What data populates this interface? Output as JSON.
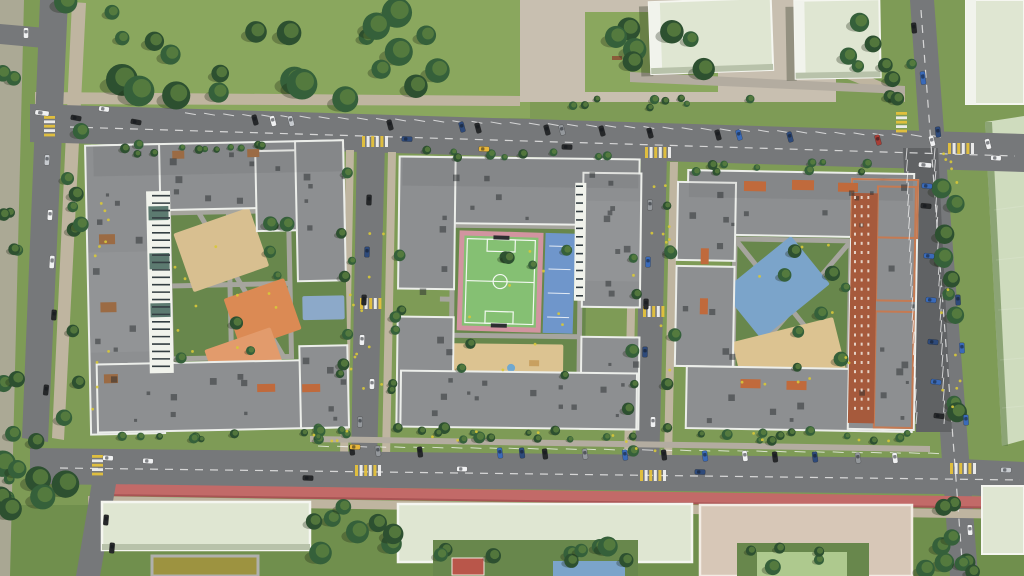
{
  "meta": {
    "scene": "aerial-residential-complex"
  },
  "palette": {
    "grass": "#7e9b56",
    "grass_dark": "#6d8c4b",
    "park": "#8aa75e",
    "lawn": "#68874c",
    "field": "#cfdcbe",
    "plaza": "#c8bfb0",
    "path": "#bfb5a0",
    "sidewalk": "#b3aca0",
    "road": "#76787a",
    "road_dark": "#606264",
    "lane_red": "#c26a68",
    "lane_red2": "#a85454",
    "line": "#eeeeee",
    "yellow": "#e5c23c",
    "roof": "#8d8f91",
    "roof_dark": "#7b7d7f",
    "parapet": "#eceeea",
    "mint": "#dfe6d2",
    "mint_face": "#f1f3ec",
    "mint_shade": "#b8c2aa",
    "brick": "#a65a3c",
    "brick_par": "#c57a52",
    "pergola": "#c06a3c",
    "pergola2": "#9b6b44",
    "tan": "#d8bf90",
    "orange1": "#db8a54",
    "orange2": "#e29b6c",
    "blue_play": "#7ba4ca",
    "blue_tarp": "#8ca9c9",
    "court_green": "#85c073",
    "court_pink": "#d294a0",
    "court_blue": "#6f96cb",
    "sand": "#dcc391",
    "olive": "#9d9340",
    "pink_bld": "#d7c7b7",
    "teal": "#5c7a70",
    "court_path": "#a6a59e",
    "unit": "rgba(40,44,46,0.5)",
    "shadow": "rgba(25,35,18,0.30)",
    "tree_dark": "#2d5030",
    "tree_mid": "#35603a",
    "tree_light": "#5f8340",
    "flower": "#d8c838",
    "red_roof": "#b9564a",
    "car": {
      "wh": "#f0f1f2",
      "bk": "#26282a",
      "gy": "#94989c",
      "nv": "#2e4a7a",
      "bl": "#3a6ab8",
      "yl": "#e8b63a",
      "rd": "#a83e36",
      "sv": "#c6cace"
    }
  },
  "scene": {
    "tree_clusters": [
      [
        60,
        0,
        440,
        100,
        24,
        7,
        16,
        1
      ],
      [
        585,
        12,
        132,
        78,
        7,
        6,
        12,
        3
      ],
      [
        838,
        18,
        58,
        82,
        5,
        6,
        11,
        4
      ],
      [
        0,
        0,
        18,
        560,
        12,
        5,
        9,
        5
      ],
      [
        62,
        70,
        24,
        360,
        9,
        5,
        9,
        6
      ],
      [
        95,
        144,
        248,
        10,
        12,
        3,
        5,
        7
      ],
      [
        400,
        150,
        232,
        10,
        10,
        3,
        5,
        8
      ],
      [
        678,
        160,
        235,
        12,
        10,
        3,
        5,
        9
      ],
      [
        340,
        152,
        12,
        305,
        7,
        4,
        7,
        10
      ],
      [
        390,
        152,
        12,
        305,
        7,
        4,
        7,
        11
      ],
      [
        626,
        162,
        12,
        300,
        6,
        4,
        7,
        12
      ],
      [
        666,
        162,
        12,
        300,
        6,
        4,
        7,
        13
      ],
      [
        940,
        138,
        20,
        430,
        13,
        6,
        10,
        14
      ],
      [
        310,
        428,
        618,
        12,
        14,
        4,
        6,
        15
      ],
      [
        170,
        212,
        122,
        160,
        8,
        4,
        8,
        16
      ],
      [
        458,
        228,
        120,
        160,
        7,
        4,
        8,
        17
      ],
      [
        737,
        242,
        112,
        155,
        8,
        4,
        8,
        18
      ],
      [
        314,
        506,
        80,
        64,
        8,
        7,
        12,
        19
      ],
      [
        0,
        440,
        88,
        134,
        8,
        8,
        14,
        20
      ],
      [
        436,
        542,
        196,
        30,
        9,
        6,
        10,
        21
      ],
      [
        740,
        548,
        124,
        26,
        5,
        5,
        8,
        22
      ],
      [
        918,
        498,
        58,
        76,
        6,
        6,
        10,
        23
      ],
      [
        520,
        98,
        315,
        10,
        9,
        3,
        5,
        24
      ],
      [
        884,
        60,
        28,
        60,
        4,
        5,
        8,
        25
      ],
      [
        100,
        432,
        240,
        10,
        9,
        3,
        5,
        26
      ],
      [
        408,
        430,
        225,
        10,
        8,
        3,
        5,
        27
      ],
      [
        690,
        432,
        222,
        10,
        8,
        3,
        5,
        28
      ]
    ],
    "flowers": [
      [
        170,
        215,
        120,
        150,
        10
      ],
      [
        458,
        230,
        120,
        140,
        8
      ],
      [
        736,
        242,
        115,
        150,
        10
      ],
      [
        346,
        155,
        40,
        300,
        12
      ],
      [
        630,
        165,
        40,
        300,
        12
      ],
      [
        90,
        150,
        20,
        280,
        10
      ],
      [
        940,
        150,
        25,
        280,
        12
      ],
      [
        310,
        430,
        620,
        12,
        14
      ]
    ],
    "roof_units": [
      [
        100,
        150,
        240,
        55,
        10,
        31
      ],
      [
        92,
        200,
        50,
        220,
        8,
        32
      ],
      [
        100,
        368,
        240,
        55,
        10,
        33
      ],
      [
        302,
        148,
        40,
        130,
        5,
        34
      ],
      [
        302,
        352,
        40,
        70,
        4,
        35
      ],
      [
        405,
        162,
        230,
        55,
        9,
        36
      ],
      [
        400,
        165,
        50,
        250,
        7,
        37
      ],
      [
        585,
        178,
        50,
        145,
        6,
        38
      ],
      [
        585,
        338,
        50,
        85,
        5,
        39
      ],
      [
        408,
        376,
        225,
        48,
        8,
        40
      ],
      [
        690,
        176,
        215,
        52,
        9,
        41
      ],
      [
        680,
        190,
        52,
        165,
        7,
        42
      ],
      [
        878,
        188,
        36,
        230,
        6,
        43
      ],
      [
        692,
        374,
        215,
        52,
        8,
        44
      ]
    ],
    "stall_rows": [
      [
        185,
        112.7,
        930,
        135.2,
        40,
        11,
        100
      ],
      [
        318,
        446,
        928,
        453,
        33,
        11,
        93
      ],
      [
        906,
        160,
        916,
        424,
        24,
        12,
        5
      ],
      [
        934,
        160,
        944,
        424,
        24,
        12,
        5
      ]
    ],
    "dashes": [
      [
        70,
        127,
        1015,
        156
      ],
      [
        60,
        468,
        1020,
        480
      ],
      [
        921,
        10,
        962,
        560
      ]
    ],
    "crosswalks": [
      [
        44,
        116,
        5,
        0
      ],
      [
        362,
        136,
        6,
        1
      ],
      [
        645,
        147,
        6,
        1
      ],
      [
        948,
        143,
        6,
        1
      ],
      [
        896,
        112,
        5,
        0
      ],
      [
        360,
        298,
        5,
        1
      ],
      [
        643,
        306,
        5,
        1
      ],
      [
        355,
        465,
        6,
        1
      ],
      [
        640,
        470,
        6,
        1
      ],
      [
        950,
        463,
        6,
        1
      ],
      [
        92,
        455,
        5,
        0
      ]
    ],
    "window_lines": [
      [
        150,
        192,
        22,
        178,
        24
      ],
      [
        574,
        182,
        11,
        118,
        14
      ]
    ],
    "brick_dots": [
      852,
      194,
      24,
      226,
      3,
      24
    ],
    "cars": [
      [
        255,
        120,
        75,
        "bk"
      ],
      [
        273,
        121,
        75,
        "wh"
      ],
      [
        291,
        121,
        75,
        "sv"
      ],
      [
        390,
        125,
        75,
        "bk"
      ],
      [
        462,
        127,
        75,
        "nv"
      ],
      [
        478,
        128,
        75,
        "bk"
      ],
      [
        547,
        130,
        75,
        "bk"
      ],
      [
        562,
        130,
        75,
        "gy"
      ],
      [
        602,
        131,
        75,
        "bk"
      ],
      [
        650,
        133,
        75,
        "bk"
      ],
      [
        718,
        135,
        75,
        "bk"
      ],
      [
        739,
        135,
        75,
        "bl"
      ],
      [
        790,
        137,
        75,
        "nv"
      ],
      [
        878,
        140,
        75,
        "rd"
      ],
      [
        932,
        141,
        75,
        "wh"
      ],
      [
        988,
        144,
        75,
        "wh"
      ],
      [
        42,
        113,
        7,
        "wh",
        14
      ],
      [
        76,
        118,
        10,
        "bk"
      ],
      [
        104,
        109,
        8,
        "wh"
      ],
      [
        136,
        122,
        10,
        "bk"
      ],
      [
        407,
        139,
        2,
        "nv"
      ],
      [
        484,
        149,
        2,
        "yl"
      ],
      [
        567,
        147,
        2,
        "bk"
      ],
      [
        26,
        33,
        90,
        "wh"
      ],
      [
        47,
        160,
        93,
        "sv"
      ],
      [
        50,
        215,
        93,
        "wh"
      ],
      [
        52,
        262,
        94,
        "wh",
        13
      ],
      [
        54,
        315,
        94,
        "bk"
      ],
      [
        46,
        390,
        96,
        "bk"
      ],
      [
        369,
        200,
        92,
        "bk"
      ],
      [
        367,
        252,
        92,
        "nv"
      ],
      [
        364,
        300,
        92,
        "bk"
      ],
      [
        362,
        340,
        92,
        "wh"
      ],
      [
        372,
        384,
        91,
        "wh"
      ],
      [
        360,
        422,
        92,
        "gy"
      ],
      [
        650,
        205,
        91,
        "gy"
      ],
      [
        648,
        262,
        91,
        "bl"
      ],
      [
        646,
        304,
        91,
        "bk"
      ],
      [
        645,
        352,
        91,
        "nv"
      ],
      [
        653,
        422,
        90,
        "wh"
      ],
      [
        914,
        28,
        84,
        "bk"
      ],
      [
        923,
        78,
        84,
        "bl",
        13
      ],
      [
        938,
        132,
        84,
        "nv"
      ],
      [
        958,
        300,
        87,
        "nv"
      ],
      [
        962,
        348,
        87,
        "bl"
      ],
      [
        966,
        420,
        87,
        "bl"
      ],
      [
        970,
        530,
        87,
        "wh"
      ],
      [
        996,
        158,
        3,
        "wh"
      ],
      [
        352,
        450,
        83,
        "bk"
      ],
      [
        378,
        451,
        83,
        "gy"
      ],
      [
        420,
        452,
        83,
        "bk"
      ],
      [
        500,
        453,
        83,
        "bl"
      ],
      [
        522,
        453,
        83,
        "nv"
      ],
      [
        545,
        454,
        83,
        "bk"
      ],
      [
        585,
        454,
        83,
        "gy"
      ],
      [
        625,
        455,
        83,
        "bl"
      ],
      [
        664,
        455,
        83,
        "bk"
      ],
      [
        705,
        456,
        83,
        "bl"
      ],
      [
        745,
        456,
        83,
        "wh"
      ],
      [
        775,
        457,
        83,
        "bk"
      ],
      [
        815,
        457,
        83,
        "nv"
      ],
      [
        858,
        458,
        83,
        "gy"
      ],
      [
        895,
        458,
        83,
        "wh"
      ],
      [
        108,
        458,
        3,
        "wh"
      ],
      [
        148,
        461,
        3,
        "wh"
      ],
      [
        308,
        478,
        2,
        "bk"
      ],
      [
        462,
        469,
        2,
        "wh"
      ],
      [
        700,
        472,
        2,
        "nv"
      ],
      [
        1006,
        470,
        2,
        "sv"
      ],
      [
        355,
        447,
        2,
        "yl"
      ],
      [
        106,
        520,
        95,
        "bk"
      ],
      [
        112,
        548,
        95,
        "bk"
      ],
      [
        925,
        165,
        5,
        "wh",
        13
      ],
      [
        927,
        186,
        5,
        "bl"
      ],
      [
        926,
        206,
        5,
        "bk"
      ],
      [
        929,
        256,
        6,
        "bl"
      ],
      [
        931,
        300,
        6,
        "bl"
      ],
      [
        933,
        342,
        6,
        "nv"
      ],
      [
        936,
        382,
        7,
        "bl"
      ],
      [
        939,
        416,
        7,
        "bk"
      ]
    ]
  }
}
